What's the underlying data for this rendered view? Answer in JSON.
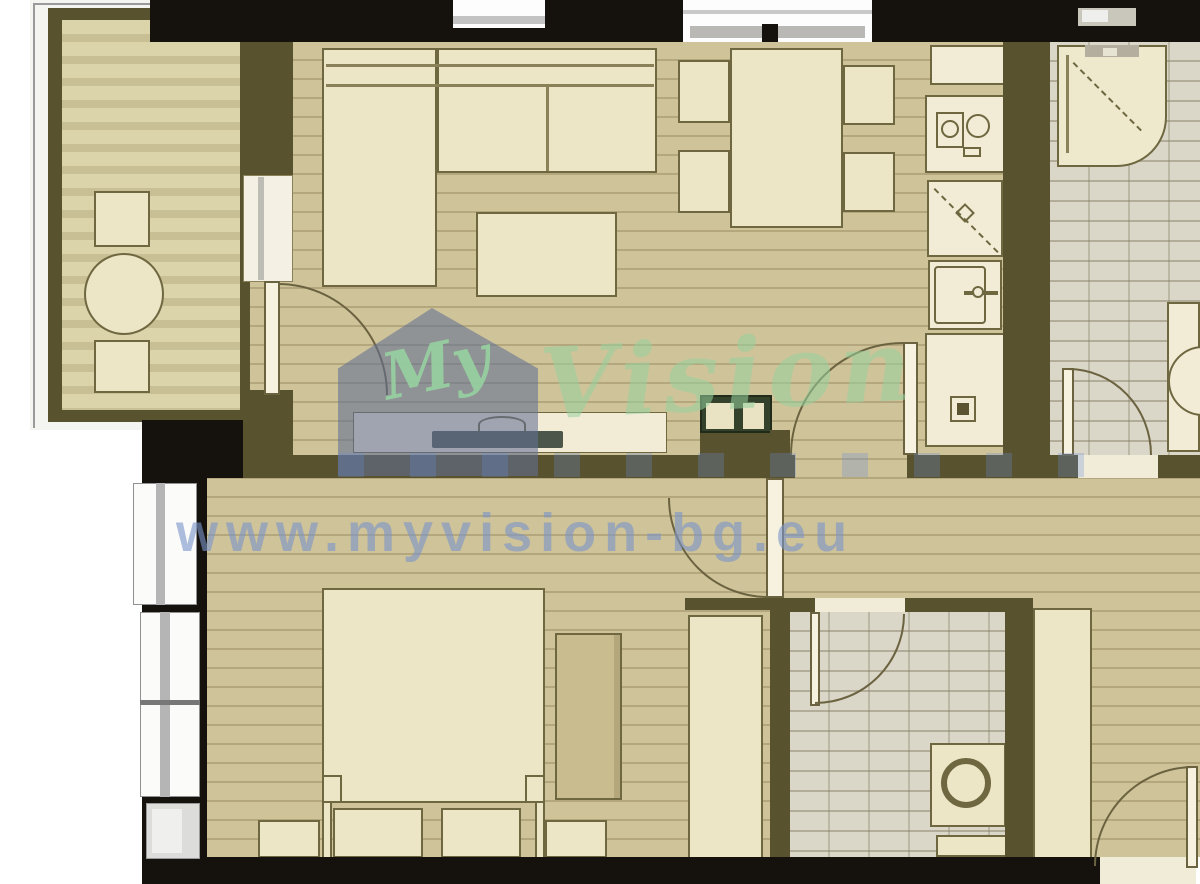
{
  "watermark": {
    "brand_first": "My",
    "brand_second": "Vision",
    "url": "www.myvision-bg.eu"
  },
  "colors": {
    "page-bg": "#ffffff",
    "floor-tan": "#cfc399",
    "tile-gray": "#dad6c8",
    "wall-olive": "#59522f",
    "wall-black": "#15120e",
    "furniture-cream": "#ece6c6",
    "furniture-border": "#6e6740",
    "arc-line": "#6b6340",
    "tv-dark": "#4d564b",
    "cabinet-green": "#35422b",
    "watermark-blue": "rgba(98,112,148,0.58)",
    "watermark-green": "rgba(140,205,150,0.75)",
    "url-blue": "rgba(122,148,202,0.62)"
  }
}
